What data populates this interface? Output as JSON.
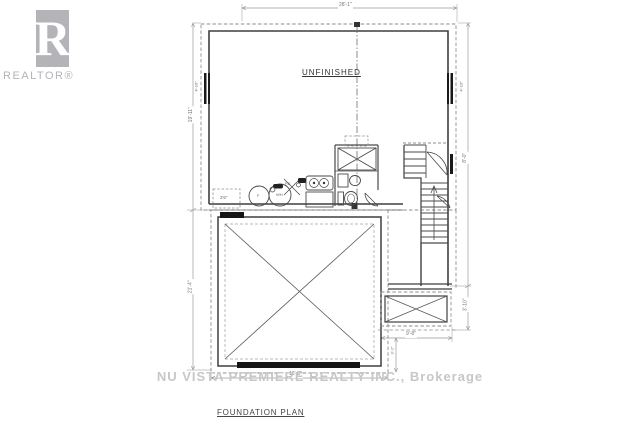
{
  "branding": {
    "logo_letter": "R",
    "logo_label": "REALTOR®"
  },
  "plan": {
    "title": "FOUNDATION PLAN",
    "room_label": "UNFINISHED",
    "watermark": "NU VISTA PREMIERE REALTY INC., Brokerage",
    "labels": {
      "cold_cellar": "2'6\"",
      "floor_drain": "FD",
      "furnace": "F",
      "water_heater": "WH"
    },
    "dimensions": {
      "top_width": "28'-1\"",
      "left_upper": "19'-11\"",
      "left_lower": "21'-4\"",
      "right_upper": "8'-0\"",
      "right_lower": "3'-10\"",
      "left_window": "4'-10\"",
      "right_window": "4'-10\"",
      "porch_width": "9'-8\"",
      "porch_offset": "3'-1\"",
      "garage_width": "16'-8\""
    }
  }
}
